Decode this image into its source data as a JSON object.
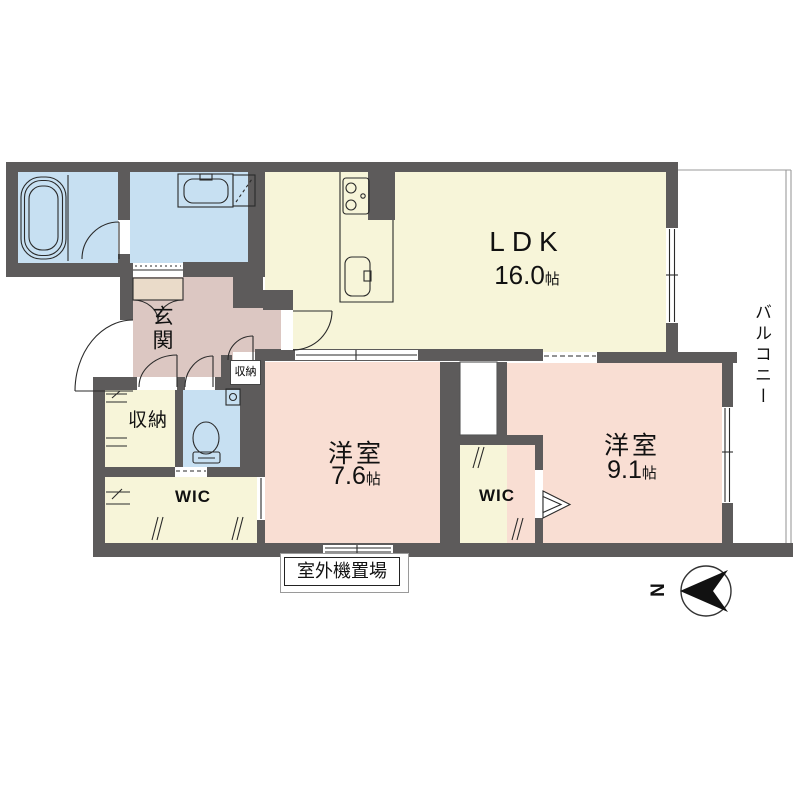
{
  "floor_plan": {
    "colors": {
      "wall": "#5d5b5b",
      "water_rooms": "#c7e0f2",
      "living_storage": "#f7f5d9",
      "bedroom": "#f9ded3",
      "hallway": "#dcc7c2",
      "cabinet": "#eadbc9"
    },
    "labels": {
      "ldk": {
        "name": "LDK",
        "area_value": "16.0",
        "area_unit": "帖"
      },
      "bedroom1": {
        "name": "洋室",
        "area_value": "7.6",
        "area_unit": "帖"
      },
      "bedroom2": {
        "name": "洋室",
        "area_value": "9.1",
        "area_unit": "帖"
      },
      "entrance": "玄関",
      "storage": "収納",
      "hall_storage": "収納",
      "wic1": "WIC",
      "wic2": "WIC",
      "balcony": "バルコニー",
      "outdoor_unit": "室外機置場",
      "north": "N"
    }
  }
}
